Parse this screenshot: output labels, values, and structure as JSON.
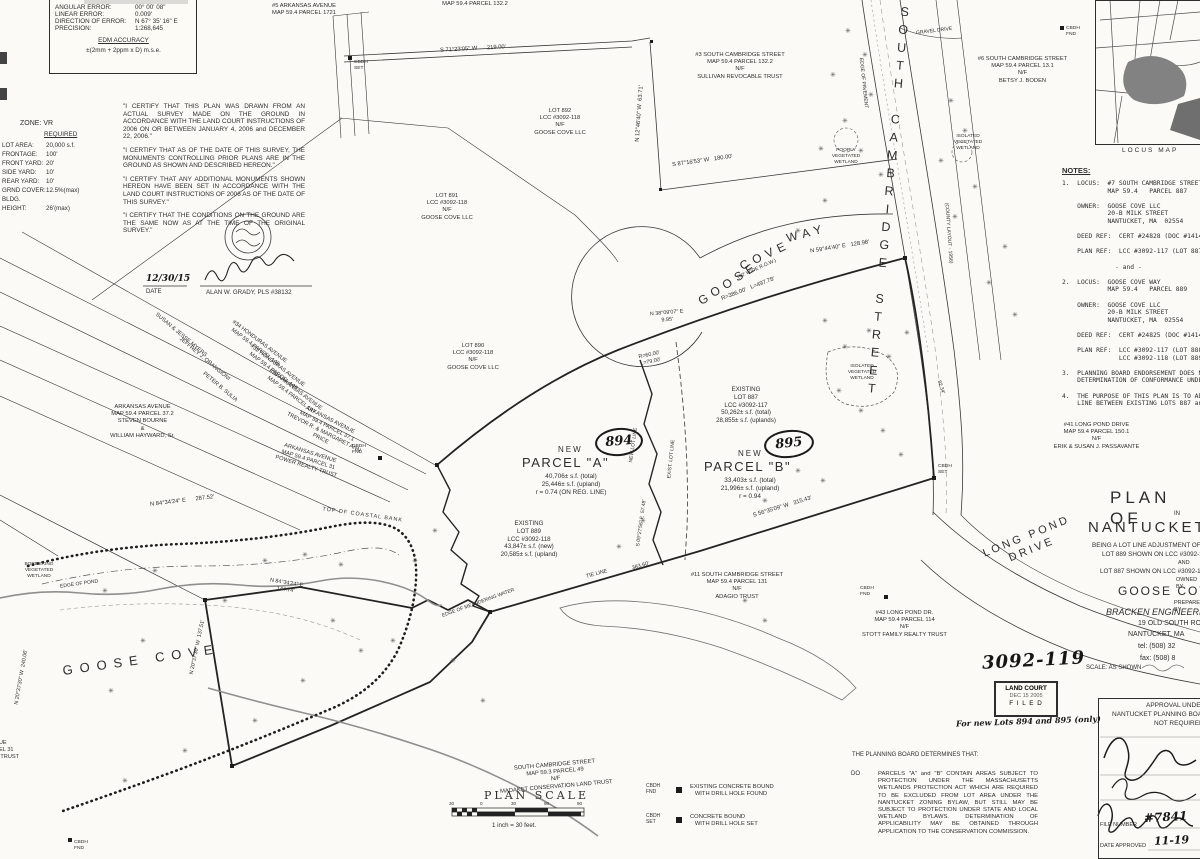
{
  "survey_box": {
    "rows": [
      [
        "ANGULAR ERROR:",
        "00° 00' 08\""
      ],
      [
        "LINEAR ERROR:",
        "0.009'"
      ],
      [
        "DIRECTION OF ERROR:",
        "N 67° 35' 16\" E"
      ],
      [
        "PRECISION:",
        "1:268,645"
      ]
    ],
    "accuracy_title": "EDM ACCURACY",
    "accuracy_value": "±(2mm + 2ppm x D) m.s.e."
  },
  "zone": {
    "title": "ZONE:  VR",
    "required": "REQUIRED",
    "rows": [
      [
        "LOT AREA:",
        "20,000 s.f."
      ],
      [
        "FRONTAGE:",
        "100'"
      ],
      [
        "FRONT YARD:",
        "20'"
      ],
      [
        "SIDE YARD:",
        "10'"
      ],
      [
        "REAR YARD:",
        "10'"
      ],
      [
        "GRND COVER:",
        "12.5%(max)"
      ],
      [
        "BLDG. HEIGHT:",
        "26'(max)"
      ]
    ]
  },
  "certifications": [
    "\"I CERTIFY THAT THIS PLAN WAS DRAWN FROM AN ACTUAL SURVEY MADE ON THE GROUND IN ACCORDANCE WITH THE LAND COURT INSTRUCTIONS OF 2006 ON OR BETWEEN JANUARY 4, 2006 and DECEMBER 22, 2006.\"",
    "\"I CERTIFY THAT AS OF THE DATE OF THIS SURVEY, THE MONUMENTS CONTROLLING PRIOR PLANS ARE IN THE GROUND AS SHOWN AND DESCRIBED HEREON.\"",
    "\"I CERTIFY THAT ANY ADDITIONAL MONUMENTS SHOWN HEREON HAVE BEEN SET IN ACCORDANCE WITH THE LAND COURT INSTRUCTIONS OF 2006 AS OF THE DATE OF THIS SURVEY.\"",
    "\"I CERTIFY THAT THE CONDITIONS ON THE GROUND ARE THE SAME NOW AS AT THE TIME OF THE ORIGINAL SURVEY.\""
  ],
  "surveyor": {
    "date": "12/30/15",
    "date_label": "DATE",
    "name": "ALAN W. GRADY, PLS #38132"
  },
  "notes": {
    "title": "NOTES:",
    "body": "1.  LOCUS:  #7 SOUTH CAMBRIDGE STREET\n            MAP 59.4   PARCEL 887\n\n    OWNER:  GOOSE COVE LLC\n            20-B MILK STREET\n            NANTUCKET, MA  02554\n\n    DEED REF:  CERT #24828 (DOC #14144\n\n    PLAN REF:  LCC #3092-117 (LOT 887)\n\n              - and -\n\n2.  LOCUS:  GOOSE COVE WAY\n            MAP 59.4   PARCEL 889\n\n    OWNER:  GOOSE COVE LLC\n            20-B MILK STREET\n            NANTUCKET, MA  02554\n\n    DEED REF:  CERT #24825 (DOC #14144\n\n    PLAN REF:  LCC #3092-117 (LOT 888\n               LCC #3092-118 (LOT 889\n\n3.  PLANNING BOARD ENDORSEMENT DOES N\n    DETERMINATION OF CONFORMANCE UNDE\n\n4.  THE PURPOSE OF THIS PLAN IS TO ADJ\n    LINE BETWEEN EXISTING LOTS 887 and"
  },
  "abutters": [
    {
      "text": "#5 ARKANSAS AVENUE\nMAP 59.4   PARCEL 1721"
    },
    {
      "text": "MAP 59.4   PARCEL 132.2"
    },
    {
      "text": "#3 SOUTH CAMBRIDGE STREET\nMAP 59.4   PARCEL 132.2\nN/F\nSULLIVAN REVOCABLE TRUST"
    },
    {
      "text": "#6 SOUTH CAMBRIDGE STREET\nMAP 59.4   PARCEL 13.1\nN/F\nBETSY J. BODEN"
    },
    {
      "text": "LOT 892\nLCC #3092-118\nN/F\nGOOSE COVE LLC"
    },
    {
      "text": "LOT 891\nLCC #3092-118\nN/F\nGOOSE COVE LLC"
    },
    {
      "text": "LOT 890\nLCC #3092-118\nN/F\nGOOSE COVE LLC"
    },
    {
      "text": "ARKANSAS AVENUE\nMAP 59.4   PARCEL 37.2\nSTEVEN BOURNE\n&\nWILLIAM HAYWARD, Sr."
    },
    {
      "text": "SUSAN & JESSE MYERS"
    },
    {
      "text": "JEFFREY J. ORANGIONI"
    },
    {
      "text": "PETER B. SULIA"
    },
    {
      "text": "#34 HONDURAS AVENUE\nMAP 59.4   PARCEL 145"
    },
    {
      "text": "#32 HONDURAS AVENUE\nMAP 59.4   PARCEL 146"
    },
    {
      "text": "#30 ARKANSAS AVENUE\nMAP 59.4   PARCEL 147"
    },
    {
      "text": "ARKANSAS AVENUE\nMAP 59.4   PARCEL 37.1\nTREVOR R. & MARGARET ANN PRICE"
    },
    {
      "text": "ARKANSAS AVENUE\nMAP 59.4   PARCEL 31\nPOWER REALTY TRUST"
    },
    {
      "text": "#11 SOUTH CAMBRIDGE STREET\nMAP 59.4   PARCEL 131\nN/F\nADAGIO TRUST"
    },
    {
      "text": "#43 LONG POND DR.\nMAP 59.4   PARCEL 114\nN/F\nSTOTT FAMILY REALTY TRUST"
    },
    {
      "text": "#41 LONG POND DRIVE\nMAP 59.4   PARCEL 150.1\nN/F\nERIK & SUSAN J. PASSAVANTE"
    },
    {
      "text": "SOUTH CAMBRIDGE STREET\nMAP 59.3   PARCEL 49\nN/F\nMADAKET CONSERVATION LAND TRUST"
    },
    {
      "text": "AVENUE\nPARCEL 31\nLAND TRUST"
    }
  ],
  "parcels": {
    "a": {
      "tag": "894",
      "new_label": "NEW",
      "name": "PARCEL  \"A\"",
      "stats": "40,706± s.f. (total)\n25,446± s.f. (upland)\nr = 0.74 (ON REG. LINE)"
    },
    "b": {
      "tag": "895",
      "new_label": "NEW",
      "name": "PARCEL  \"B\"",
      "stats": "33,403± s.f. (total)\n21,996± s.f. (upland)\nr = 0.94"
    },
    "lot887": "EXISTING\nLOT 887\nLCC #3092-117\n50,262± s.f. (total)\n28,855± s.f. (uplands)",
    "lot889": "EXISTING\nLOT 889\nLCC #3092-118\n43,847± s.f. (new)\n20,585± s.f. (upland)"
  },
  "streets": {
    "south_cambridge": "SOUTH CAMBRIDGE STREET",
    "goose": "GOOSE",
    "cove": "COVE",
    "way": "WAY",
    "row": "(40' WIDE R.O.W.)",
    "long_pond": "LONG  POND\nDRIVE",
    "county": "(COUNTY LAYOUT - 1956)",
    "gravel": "GRAVEL DRIVE",
    "pavement": "EDGE OF PAVEMENT"
  },
  "water": {
    "goose_cove": "GOOSE  COVE",
    "edge_of_pond": "EDGE OF POND",
    "coastal_bank": "TOP OF COASTAL BANK",
    "tie_line": "TIE LINE",
    "meander": "EDGE OF MEANDERING WATER",
    "bordering": "BORDERING\nVEGETATED\nWETLAND",
    "isolated": "ISOLATED\nVEGETATED\nWETLAND",
    "poorly": "POORLY\nVEGETATED\nWETLAND",
    "new_lot_line": "NEW LOT LINE",
    "exist_lot_line": "EXIST. LOT LINE"
  },
  "bearings": [
    "S 71°23'05\" W      219.00'",
    "N 12°46'40\" W  63.71'",
    "S 87°16'53\" W   180.00'",
    "N 59°44'40\" E   128.98'",
    "R=386.00'   L=497.78'",
    "N 38°09'07\" E\n9.95'",
    "R=60.00'\nL=79.00'",
    "S 56°35'09\" W   315.43'",
    "383.60'",
    "N 84°34'24\" E      287.52'",
    "N 84°34'24\" E\n144.74'",
    "N 20°37'30\" W  240.06'",
    "N 20°37'30\" W  137.51'",
    "S 09°27'56\" E  57.48'",
    "82.34'"
  ],
  "markers": {
    "fnd": "CBDH\nFND",
    "set": "CBDH\nSET"
  },
  "legend": {
    "item1_label": "CBDH\nFND",
    "item1_text": "EXISTING CONCRETE BOUND\n   WITH DRILL HOLE FOUND",
    "item2_label": "CBDH\nSET",
    "item2_text": "CONCRETE BOUND\n   WITH DRILL HOLE SET"
  },
  "scale": {
    "title": "PLAN  SCALE",
    "note": "1 inch = 30 feet.",
    "ticks": [
      "30",
      "0",
      "30",
      "60",
      "90"
    ]
  },
  "title_block": {
    "l1": "PLAN  OF",
    "l2": "IN",
    "l3": "NANTUCKET",
    "l4": "BEING A LOT LINE ADJUSTMENT OF",
    "l5": "LOT 889 SHOWN ON LCC #3092-118",
    "l6": "AND",
    "l7": "LOT 887 SHOWN ON LCC #3092-117",
    "l8": "OWNED BY",
    "l9": "GOOSE COVE LLC",
    "l10": "PREPARED BY",
    "l11": "BRACKEN ENGINEERING",
    "l12": "19 OLD SOUTH ROAD",
    "l13": "NANTUCKET, MA",
    "l14": "tel: (508) 32",
    "l15": "fax: (508) 8",
    "l16": "SCALE: AS SHOWN"
  },
  "approval": {
    "l1": "APPROVAL UNDER THE",
    "l2": "NANTUCKET PLANNING BOARD",
    "l3": "NOT REQUIRED",
    "file_label": "FILE NUMBER",
    "file_value": "#7841",
    "date_label": "DATE APPROVED",
    "date_value": "11-19"
  },
  "land_court": {
    "number": "3092-119",
    "stamp_l1": "LAND COURT",
    "stamp_l2": "DEC 15 2005",
    "stamp_l3": "F I L E D",
    "note": "For new Lots 894 and 895 (only)"
  },
  "planning": {
    "intro": "THE PLANNING BOARD DETERMINES THAT:",
    "item_label": "DO",
    "item_text": "PARCELS \"A\" and \"B\" CONTAIN AREAS SUBJECT TO PROTECTION UNDER THE MASSACHUSETTS WETLANDS PROTECTION ACT WHICH ARE REQUIRED TO BE EXCLUDED FROM LOT AREA UNDER THE NANTUCKET ZONING BYLAW, BUT STILL MAY BE SUBJECT TO PROTECTION UNDER STATE AND LOCAL WETLAND BYLAWS.  DETERMINATION OF APPLICABILITY MAY BE OBTAINED THROUGH APPLICATION TO THE CONSERVATION COMMISSION."
  },
  "locus": {
    "caption": "LOCUS MAP"
  },
  "icons": {
    "shrub": "✳"
  },
  "decor": {
    "shrubs": [
      [
        845,
        28
      ],
      [
        862,
        52
      ],
      [
        830,
        72
      ],
      [
        868,
        92
      ],
      [
        842,
        118
      ],
      [
        818,
        146
      ],
      [
        858,
        148
      ],
      [
        878,
        172
      ],
      [
        822,
        198
      ],
      [
        795,
        228
      ],
      [
        948,
        98
      ],
      [
        962,
        128
      ],
      [
        938,
        158
      ],
      [
        972,
        184
      ],
      [
        952,
        214
      ],
      [
        1002,
        244
      ],
      [
        986,
        280
      ],
      [
        1012,
        312
      ],
      [
        822,
        318
      ],
      [
        842,
        344
      ],
      [
        866,
        328
      ],
      [
        886,
        354
      ],
      [
        904,
        330
      ],
      [
        836,
        388
      ],
      [
        858,
        408
      ],
      [
        880,
        428
      ],
      [
        898,
        452
      ],
      [
        795,
        468
      ],
      [
        762,
        498
      ],
      [
        820,
        478
      ],
      [
        742,
        598
      ],
      [
        762,
        618
      ],
      [
        640,
        518
      ],
      [
        616,
        544
      ],
      [
        302,
        552
      ],
      [
        338,
        562
      ],
      [
        262,
        558
      ],
      [
        152,
        568
      ],
      [
        102,
        588
      ],
      [
        222,
        598
      ],
      [
        330,
        618
      ],
      [
        358,
        648
      ],
      [
        300,
        678
      ],
      [
        252,
        718
      ],
      [
        182,
        748
      ],
      [
        122,
        778
      ],
      [
        432,
        528
      ],
      [
        412,
        558
      ],
      [
        390,
        638
      ],
      [
        450,
        658
      ],
      [
        480,
        698
      ],
      [
        140,
        638
      ],
      [
        108,
        688
      ]
    ]
  }
}
